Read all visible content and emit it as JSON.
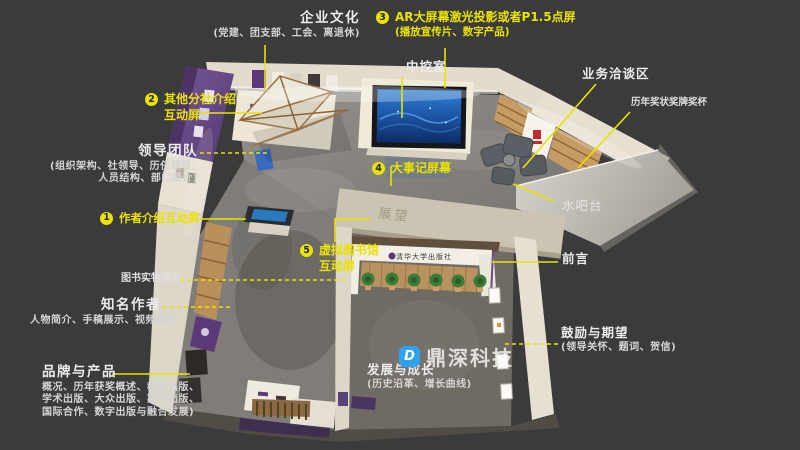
{
  "page": {
    "background": "#3b3b3b",
    "accent_yellow": "#e9e300",
    "label_white": "#ececec"
  },
  "watermark": {
    "brand": "鼎深科技",
    "logo_letter": "D",
    "logo_color": "#2fa2ec"
  },
  "render": {
    "wall_sign": "展望",
    "entrance_sign": "清华大学出版社"
  },
  "labels": {
    "qiye": {
      "title": "企业文化",
      "sub": "(党建、团支部、工会、离退休)"
    },
    "ar": {
      "num": "3",
      "title": "AR大屏幕激光投影或者P1.5点屏",
      "sub": "(播放宣传片、数字产品)"
    },
    "zhongkong": {
      "title": "中控室"
    },
    "yewu": {
      "title": "业务洽谈区"
    },
    "jiangbei": {
      "title": "历年奖状奖牌奖杯"
    },
    "fenshe": {
      "num": "2",
      "line1": "其他分社介绍",
      "line2": "互动屏"
    },
    "lingdao": {
      "title": "领导团队",
      "sub1": "(组织架构、社领导、历任领导、",
      "sub2": "人员结构、部门简介)"
    },
    "zuozhe": {
      "num": "1",
      "title": "作者介绍互动屏"
    },
    "dashiji": {
      "num": "4",
      "title": "大事记屏幕"
    },
    "xuni": {
      "num": "5",
      "line1": "虚拟图书馆",
      "line2": "互动屏"
    },
    "tushu": {
      "title": "图书实物展示"
    },
    "zhiming": {
      "title": "知名作者",
      "sub": "人物简介、手稿展示、视频展示"
    },
    "pinpai": {
      "title": "品牌与产品",
      "sub1": "概况、历年获奖概述、教育出版、",
      "sub2": "学术出版、大众出版、期刊出版、",
      "sub3": "国际合作、数字出版与融合发展)"
    },
    "fazhan": {
      "title": "发展与成长",
      "sub": "(历史沿革、增长曲线)"
    },
    "guli": {
      "title": "鼓励与期望",
      "sub": "(领导关怀、题词、贺信)"
    },
    "qianyan": {
      "title": "前言"
    },
    "shuiba": {
      "title": "水吧台"
    }
  }
}
